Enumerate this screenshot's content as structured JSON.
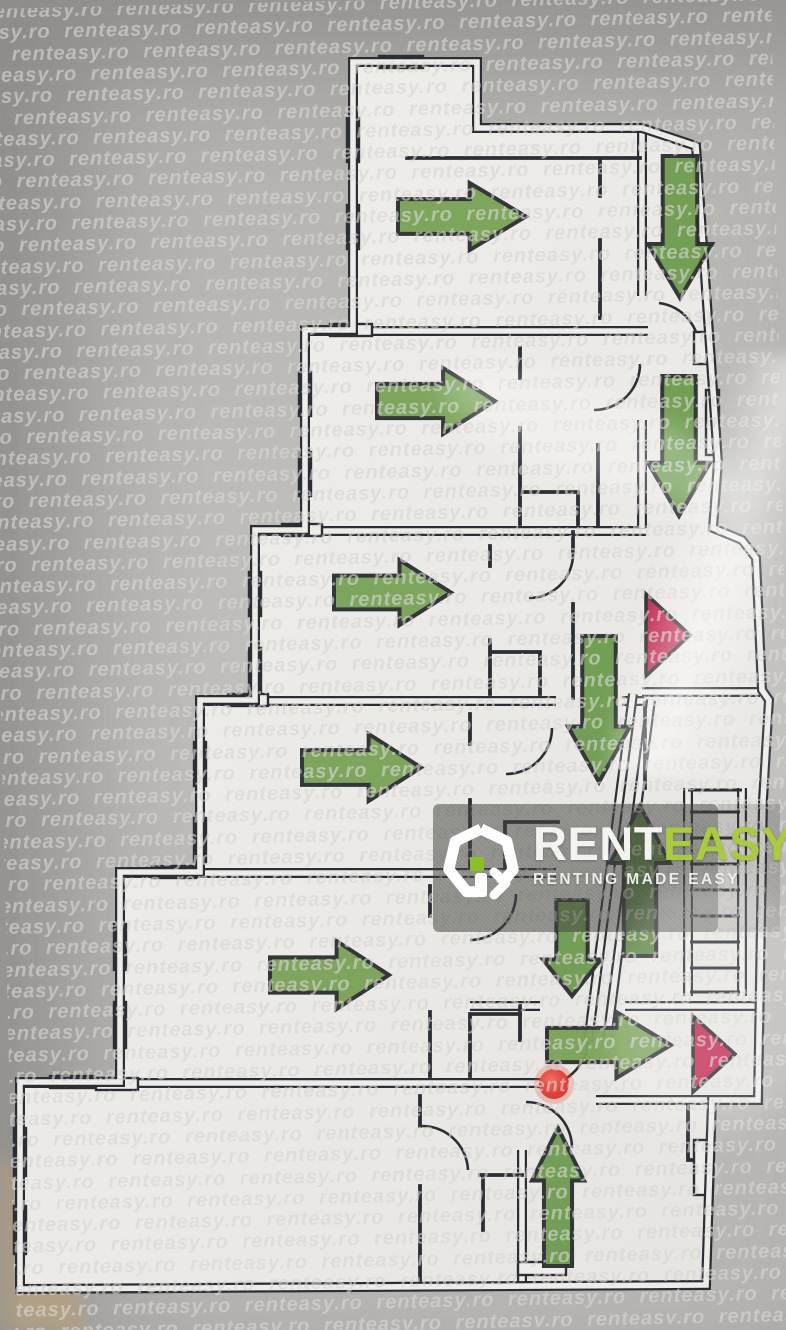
{
  "watermark": {
    "text": "renteasy.ro",
    "rows": 63,
    "repeats_per_row": 11,
    "row_height": 21.3
  },
  "logo": {
    "brand_prefix": "RENT",
    "brand_suffix": "EASY",
    "tagline": "RENTING MADE EASY",
    "prefix_color": "#f3f3f1",
    "suffix_color": "#a8cc3a",
    "icon": "house-ring-icon",
    "icon_accent_color": "#8bc024"
  },
  "plan": {
    "background_color": "#b0aeab",
    "room_color": "#edece8",
    "wall_color": "#2b2e35",
    "arrow_outline_color": "#2c3031",
    "arrows": [
      {
        "name": "route-arrow-floor1-right",
        "dir": "right",
        "x": 398,
        "y": 183,
        "w": 128,
        "h": 67,
        "color": "#79a457"
      },
      {
        "name": "route-arrow-floor1-corridor-down",
        "dir": "down",
        "x": 648,
        "y": 156,
        "w": 64,
        "h": 142,
        "color": "#6f9c50"
      },
      {
        "name": "route-arrow-floor2-right",
        "dir": "right",
        "x": 377,
        "y": 368,
        "w": 118,
        "h": 66,
        "color": "#79a457"
      },
      {
        "name": "route-arrow-floor2-corridor-down",
        "dir": "down",
        "x": 648,
        "y": 376,
        "w": 62,
        "h": 140,
        "color": "#6f9c50"
      },
      {
        "name": "route-arrow-floor3-right",
        "dir": "right",
        "x": 334,
        "y": 560,
        "w": 117,
        "h": 65,
        "color": "#79a457"
      },
      {
        "name": "route-arrow-floor3-corridor-down",
        "dir": "down",
        "x": 568,
        "y": 636,
        "w": 62,
        "h": 146,
        "color": "#6f9c50"
      },
      {
        "name": "route-arrow-floor4-right",
        "dir": "right",
        "x": 302,
        "y": 734,
        "w": 119,
        "h": 67,
        "color": "#79a457"
      },
      {
        "name": "route-arrow-stairs-up",
        "dir": "up",
        "x": 610,
        "y": 806,
        "w": 60,
        "h": 150,
        "color": "#5c8743"
      },
      {
        "name": "route-arrow-floor5-right",
        "dir": "right",
        "x": 270,
        "y": 941,
        "w": 119,
        "h": 68,
        "color": "#7aa258"
      },
      {
        "name": "route-arrow-hall-down",
        "dir": "down",
        "x": 543,
        "y": 900,
        "w": 58,
        "h": 96,
        "color": "#6f9c50"
      },
      {
        "name": "route-arrow-floor6-corridor-right",
        "dir": "right",
        "x": 547,
        "y": 1012,
        "w": 124,
        "h": 66,
        "color": "#7aa258"
      },
      {
        "name": "route-arrow-exit-up",
        "dir": "up",
        "x": 532,
        "y": 1128,
        "w": 52,
        "h": 138,
        "color": "#6f9c50"
      }
    ],
    "exit_markers": [
      {
        "name": "exit-triangle-upper",
        "points": [
          [
            646,
            594
          ],
          [
            646,
            676
          ],
          [
            690,
            635
          ]
        ],
        "color": "#c32a52"
      },
      {
        "name": "exit-triangle-lower",
        "points": [
          [
            693,
            1016
          ],
          [
            693,
            1092
          ],
          [
            735,
            1054
          ]
        ],
        "color": "#c32a52"
      }
    ],
    "you_are_here": {
      "name": "you-are-here-dot",
      "cx": 554,
      "cy": 1084,
      "r": 15,
      "color": "#d93832"
    }
  }
}
